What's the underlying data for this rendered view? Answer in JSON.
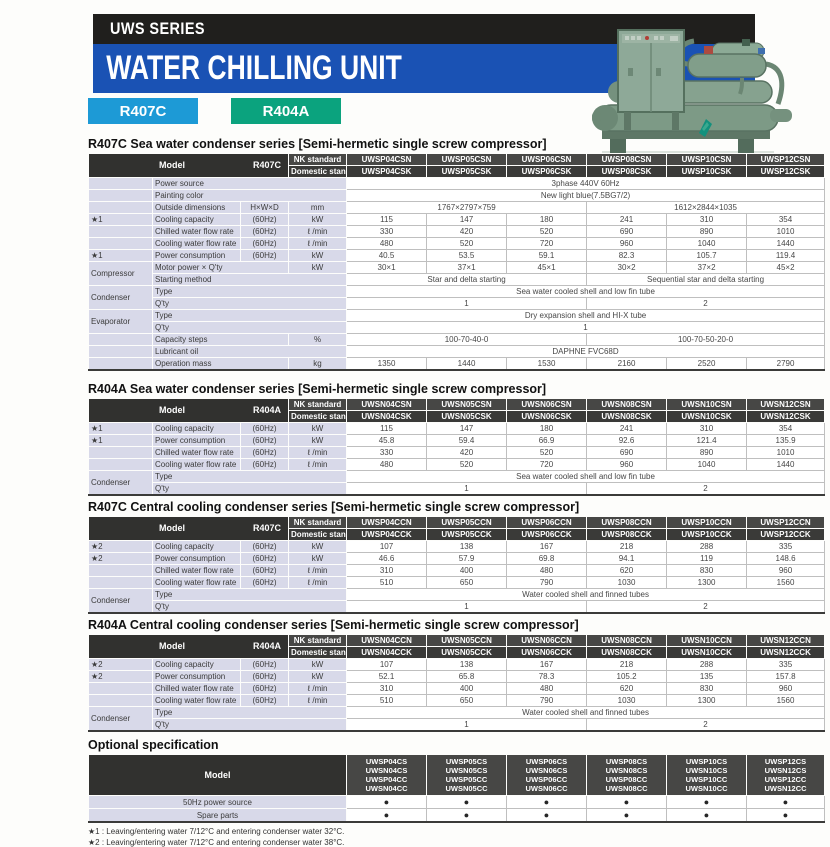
{
  "header": {
    "series_label": "UWS SERIES",
    "title": "WATER CHILLING UNIT",
    "badges": [
      {
        "label": "R407C",
        "color": "#1d9ad6"
      },
      {
        "label": "R404A",
        "color": "#0ba37e"
      }
    ],
    "photo_alt": "water-chilling-unit-photo"
  },
  "column_headers": {
    "model": "Model",
    "nk": "NK standard",
    "domestic": "Domestic standard"
  },
  "tables": [
    {
      "title": "R407C Sea water condenser series [Semi-hermetic single screw compressor]",
      "model_code": "R407C",
      "nk_models": [
        "UWSP04CSN",
        "UWSP05CSN",
        "UWSP06CSN",
        "UWSP08CSN",
        "UWSP10CSN",
        "UWSP12CSN"
      ],
      "domestic_models": [
        "UWSP04CSK",
        "UWSP05CSK",
        "UWSP06CSK",
        "UWSP08CSK",
        "UWSP10CSK",
        "UWSP12CSK"
      ],
      "rows": [
        {
          "g": "",
          "l": "Power source",
          "d": [
            [
              "3phase 440V  60Hz",
              6
            ]
          ]
        },
        {
          "g": "",
          "l": "Painting color",
          "d": [
            [
              "New light blue(7.5BG7/2)",
              6
            ]
          ]
        },
        {
          "g": "",
          "l": "Outside dimensions",
          "sub": "H×W×D",
          "u": "mm",
          "d": [
            [
              "1767×2797×759",
              3
            ],
            [
              "1612×2844×1035",
              3
            ]
          ]
        },
        {
          "g": "★1",
          "l": "Cooling capacity",
          "sub": "(60Hz)",
          "u": "kW",
          "d": [
            "115",
            "147",
            "180",
            "241",
            "310",
            "354"
          ]
        },
        {
          "g": "",
          "l": "Chilled water flow rate",
          "sub": "(60Hz)",
          "u": "ℓ /min",
          "d": [
            "330",
            "420",
            "520",
            "690",
            "890",
            "1010"
          ]
        },
        {
          "g": "",
          "l": "Cooling water flow rate",
          "sub": "(60Hz)",
          "u": "ℓ /min",
          "d": [
            "480",
            "520",
            "720",
            "960",
            "1040",
            "1440"
          ]
        },
        {
          "g": "★1",
          "l": "Power consumption",
          "sub": "(60Hz)",
          "u": "kW",
          "d": [
            "40.5",
            "53.5",
            "59.1",
            "82.3",
            "105.7",
            "119.4"
          ]
        },
        {
          "g": "Compressor",
          "gs": 2,
          "l": "Motor power × Q'ty",
          "u": "kW",
          "d": [
            "30×1",
            "37×1",
            "45×1",
            "30×2",
            "37×2",
            "45×2"
          ]
        },
        {
          "g": null,
          "l": "Starting method",
          "d": [
            [
              "Star and delta starting",
              3
            ],
            [
              "Sequential star and delta starting",
              3
            ]
          ]
        },
        {
          "g": "Condenser",
          "gs": 2,
          "l": "Type",
          "d": [
            [
              "Sea water cooled shell and low fin tube",
              6
            ]
          ]
        },
        {
          "g": null,
          "l": "Q'ty",
          "d": [
            [
              "1",
              3
            ],
            [
              "2",
              3
            ]
          ]
        },
        {
          "g": "Evaporator",
          "gs": 2,
          "l": "Type",
          "d": [
            [
              "Dry expansion shell and HI-X tube",
              6
            ]
          ]
        },
        {
          "g": null,
          "l": "Q'ty",
          "d": [
            [
              "1",
              6
            ]
          ]
        },
        {
          "g": "",
          "l": "Capacity steps",
          "u": "%",
          "d": [
            [
              "100-70-40-0",
              3
            ],
            [
              "100-70-50-20-0",
              3
            ]
          ]
        },
        {
          "g": "",
          "l": "Lubricant oil",
          "d": [
            [
              "DAPHNE FVC68D",
              6
            ]
          ]
        },
        {
          "g": "",
          "l": "Operation mass",
          "u": "kg",
          "d": [
            "1350",
            "1440",
            "1530",
            "2160",
            "2520",
            "2790"
          ]
        }
      ]
    },
    {
      "title": "R404A Sea water condenser series [Semi-hermetic single screw compressor]",
      "model_code": "R404A",
      "nk_models": [
        "UWSN04CSN",
        "UWSN05CSN",
        "UWSN06CSN",
        "UWSN08CSN",
        "UWSN10CSN",
        "UWSN12CSN"
      ],
      "domestic_models": [
        "UWSN04CSK",
        "UWSN05CSK",
        "UWSN06CSK",
        "UWSN08CSK",
        "UWSN10CSK",
        "UWSN12CSK"
      ],
      "rows": [
        {
          "g": "★1",
          "l": "Cooling capacity",
          "sub": "(60Hz)",
          "u": "kW",
          "d": [
            "115",
            "147",
            "180",
            "241",
            "310",
            "354"
          ]
        },
        {
          "g": "★1",
          "l": "Power consumption",
          "sub": "(60Hz)",
          "u": "kW",
          "d": [
            "45.8",
            "59.4",
            "66.9",
            "92.6",
            "121.4",
            "135.9"
          ]
        },
        {
          "g": "",
          "l": "Chilled water flow rate",
          "sub": "(60Hz)",
          "u": "ℓ /min",
          "d": [
            "330",
            "420",
            "520",
            "690",
            "890",
            "1010"
          ]
        },
        {
          "g": "",
          "l": "Cooling water flow rate",
          "sub": "(60Hz)",
          "u": "ℓ /min",
          "d": [
            "480",
            "520",
            "720",
            "960",
            "1040",
            "1440"
          ]
        },
        {
          "g": "Condenser",
          "gs": 2,
          "l": "Type",
          "d": [
            [
              "Sea water cooled shell and low fin tube",
              6
            ]
          ]
        },
        {
          "g": null,
          "l": "Q'ty",
          "d": [
            [
              "1",
              3
            ],
            [
              "2",
              3
            ]
          ]
        }
      ]
    },
    {
      "title": "R407C Central cooling condenser series [Semi-hermetic single screw compressor]",
      "model_code": "R407C",
      "nk_models": [
        "UWSP04CCN",
        "UWSP05CCN",
        "UWSP06CCN",
        "UWSP08CCN",
        "UWSP10CCN",
        "UWSP12CCN"
      ],
      "domestic_models": [
        "UWSP04CCK",
        "UWSP05CCK",
        "UWSP06CCK",
        "UWSP08CCK",
        "UWSP10CCK",
        "UWSP12CCK"
      ],
      "rows": [
        {
          "g": "★2",
          "l": "Cooling capacity",
          "sub": "(60Hz)",
          "u": "kW",
          "d": [
            "107",
            "138",
            "167",
            "218",
            "288",
            "335"
          ]
        },
        {
          "g": "★2",
          "l": "Power consumption",
          "sub": "(60Hz)",
          "u": "kW",
          "d": [
            "46.6",
            "57.9",
            "69.8",
            "94.1",
            "119",
            "148.6"
          ]
        },
        {
          "g": "",
          "l": "Chilled water flow rate",
          "sub": "(60Hz)",
          "u": "ℓ /min",
          "d": [
            "310",
            "400",
            "480",
            "620",
            "830",
            "960"
          ]
        },
        {
          "g": "",
          "l": "Cooling water flow rate",
          "sub": "(60Hz)",
          "u": "ℓ /min",
          "d": [
            "510",
            "650",
            "790",
            "1030",
            "1300",
            "1560"
          ]
        },
        {
          "g": "Condenser",
          "gs": 2,
          "l": "Type",
          "d": [
            [
              "Water cooled shell and finned tubes",
              6
            ]
          ]
        },
        {
          "g": null,
          "l": "Q'ty",
          "d": [
            [
              "1",
              3
            ],
            [
              "2",
              3
            ]
          ]
        }
      ]
    },
    {
      "title": "R404A Central cooling condenser series [Semi-hermetic single screw compressor]",
      "model_code": "R404A",
      "nk_models": [
        "UWSN04CCN",
        "UWSN05CCN",
        "UWSN06CCN",
        "UWSN08CCN",
        "UWSN10CCN",
        "UWSN12CCN"
      ],
      "domestic_models": [
        "UWSN04CCK",
        "UWSN05CCK",
        "UWSN06CCK",
        "UWSN08CCK",
        "UWSN10CCK",
        "UWSN12CCK"
      ],
      "rows": [
        {
          "g": "★2",
          "l": "Cooling capacity",
          "sub": "(60Hz)",
          "u": "kW",
          "d": [
            "107",
            "138",
            "167",
            "218",
            "288",
            "335"
          ]
        },
        {
          "g": "★2",
          "l": "Power consumption",
          "sub": "(60Hz)",
          "u": "kW",
          "d": [
            "52.1",
            "65.8",
            "78.3",
            "105.2",
            "135",
            "157.8"
          ]
        },
        {
          "g": "",
          "l": "Chilled water flow rate",
          "sub": "(60Hz)",
          "u": "ℓ /min",
          "d": [
            "310",
            "400",
            "480",
            "620",
            "830",
            "960"
          ]
        },
        {
          "g": "",
          "l": "Cooling water flow rate",
          "sub": "(60Hz)",
          "u": "ℓ /min",
          "d": [
            "510",
            "650",
            "790",
            "1030",
            "1300",
            "1560"
          ]
        },
        {
          "g": "Condenser",
          "gs": 2,
          "l": "Type",
          "d": [
            [
              "Water cooled shell and finned tubes",
              6
            ]
          ]
        },
        {
          "g": null,
          "l": "Q'ty",
          "d": [
            [
              "1",
              3
            ],
            [
              "2",
              3
            ]
          ]
        }
      ]
    }
  ],
  "optional": {
    "heading": "Optional specification",
    "model_label": "Model",
    "dot": "●",
    "columns": [
      [
        "UWSP04CS",
        "UWSN04CS",
        "UWSP04CC",
        "UWSN04CC"
      ],
      [
        "UWSP05CS",
        "UWSN05CS",
        "UWSP05CC",
        "UWSN05CC"
      ],
      [
        "UWSP06CS",
        "UWSN06CS",
        "UWSP06CC",
        "UWSN06CC"
      ],
      [
        "UWSP08CS",
        "UWSN08CS",
        "UWSP08CC",
        "UWSN08CC"
      ],
      [
        "UWSP10CS",
        "UWSN10CS",
        "UWSP10CC",
        "UWSN10CC"
      ],
      [
        "UWSP12CS",
        "UWSN12CS",
        "UWSP12CC",
        "UWSN12CC"
      ]
    ],
    "rows": [
      {
        "label": "50Hz power source",
        "dots": [
          true,
          true,
          true,
          true,
          true,
          true
        ]
      },
      {
        "label": "Spare parts",
        "dots": [
          true,
          true,
          true,
          true,
          true,
          true
        ]
      }
    ]
  },
  "footnotes": [
    "★1 : Leaving/entering water 7/12°C and entering condenser water 32°C.",
    "★2 : Leaving/entering water 7/12°C and entering condenser water 38°C."
  ]
}
